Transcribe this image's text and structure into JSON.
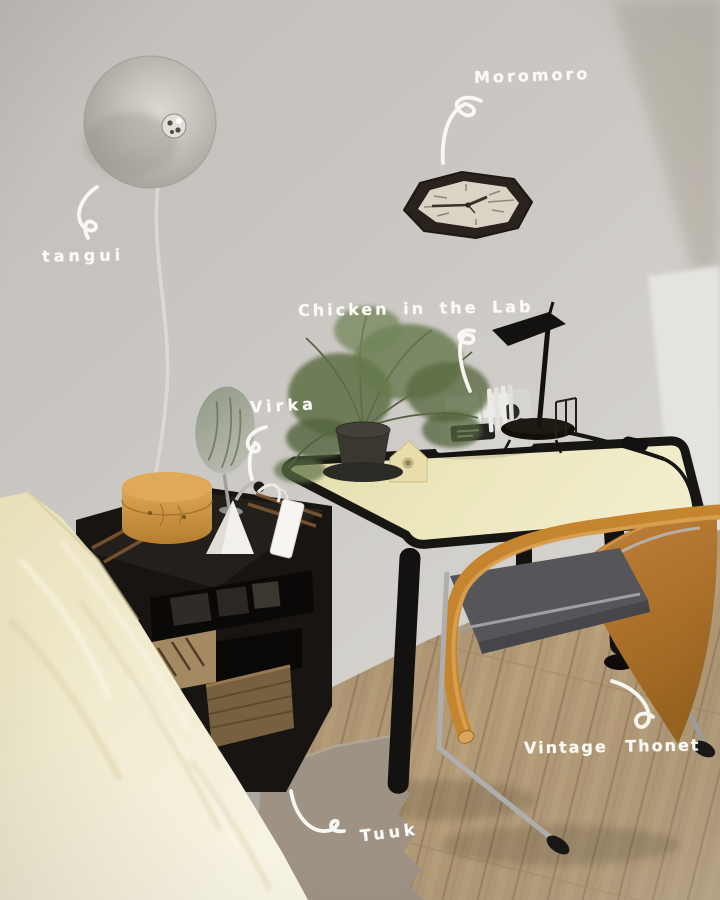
{
  "annotations": [
    {
      "label": "tangui",
      "target": "wall-lamp"
    },
    {
      "label": "Moromoro",
      "target": "wall-clock"
    },
    {
      "label": "Chicken in the Lab",
      "target": "desk-lamp"
    },
    {
      "label": "Virka",
      "target": "table-mirror"
    },
    {
      "label": "Vintage Thonet",
      "target": "chair"
    },
    {
      "label": "Tuuk",
      "target": "rug"
    }
  ],
  "palette": {
    "annotation_ink": "#fbfaf5",
    "wall": "#c8c4c0",
    "desk_top": "#eae5b9",
    "desk_frame": "#17140f",
    "chair_wood": "#c5852f",
    "chair_seat": "#56565a",
    "floor_wood": "#b49b78",
    "bedding": "#f2ecd4",
    "rug": "#9e9284",
    "side_table": "#171411",
    "lamp_disc": "#c2bdb6",
    "clock_frame": "#2a231d",
    "clock_face": "#dbd4c6",
    "plant_green": "#5e7046",
    "shaker_box": "#d29a46",
    "mirror_glass": "#97a08c",
    "cone_lamp": "#f2f0eb"
  }
}
